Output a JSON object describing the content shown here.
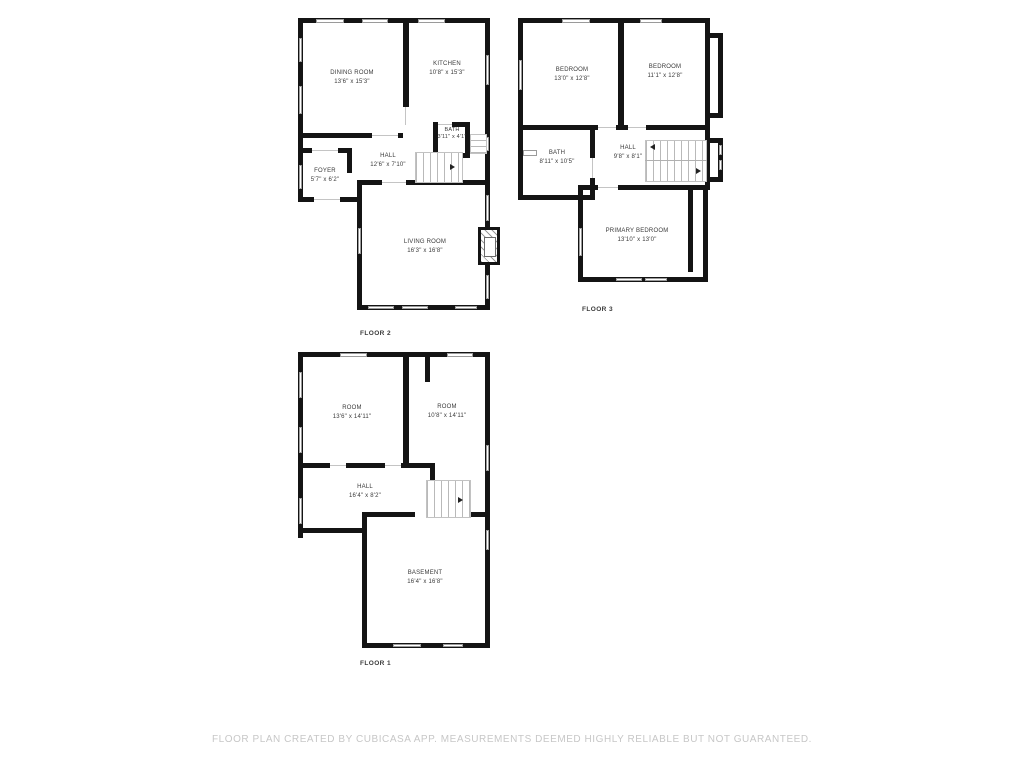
{
  "disclaimer": "FLOOR PLAN CREATED BY CUBICASA APP. MEASUREMENTS DEEMED HIGHLY RELIABLE BUT NOT GUARANTEED.",
  "colors": {
    "wall": "#141414",
    "label": "#3a3a3a",
    "window_outline": "#9a9a9a",
    "disclaimer": "#c7c7c7"
  },
  "floors": [
    {
      "name": "FLOOR 2",
      "rooms": [
        {
          "name": "DINING ROOM",
          "dims": "13'6\" x 15'3\""
        },
        {
          "name": "KITCHEN",
          "dims": "10'8\" x 15'3\""
        },
        {
          "name": "BATH",
          "dims": "3'11\" x 4'1\""
        },
        {
          "name": "HALL",
          "dims": "12'6\" x 7'10\""
        },
        {
          "name": "FOYER",
          "dims": "5'7\" x 6'2\""
        },
        {
          "name": "LIVING ROOM",
          "dims": "16'3\" x 16'8\""
        }
      ]
    },
    {
      "name": "FLOOR 3",
      "rooms": [
        {
          "name": "BEDROOM",
          "dims": "13'0\" x 12'8\""
        },
        {
          "name": "BEDROOM",
          "dims": "11'1\" x 12'8\""
        },
        {
          "name": "BATH",
          "dims": "8'11\" x 10'5\""
        },
        {
          "name": "HALL",
          "dims": "9'8\" x 8'1\""
        },
        {
          "name": "PRIMARY BEDROOM",
          "dims": "13'10\" x 13'0\""
        }
      ]
    },
    {
      "name": "FLOOR 1",
      "rooms": [
        {
          "name": "ROOM",
          "dims": "13'6\" x 14'11\""
        },
        {
          "name": "ROOM",
          "dims": "10'8\" x 14'11\""
        },
        {
          "name": "HALL",
          "dims": "16'4\" x 8'2\""
        },
        {
          "name": "BASEMENT",
          "dims": "16'4\" x 16'8\""
        }
      ]
    }
  ]
}
